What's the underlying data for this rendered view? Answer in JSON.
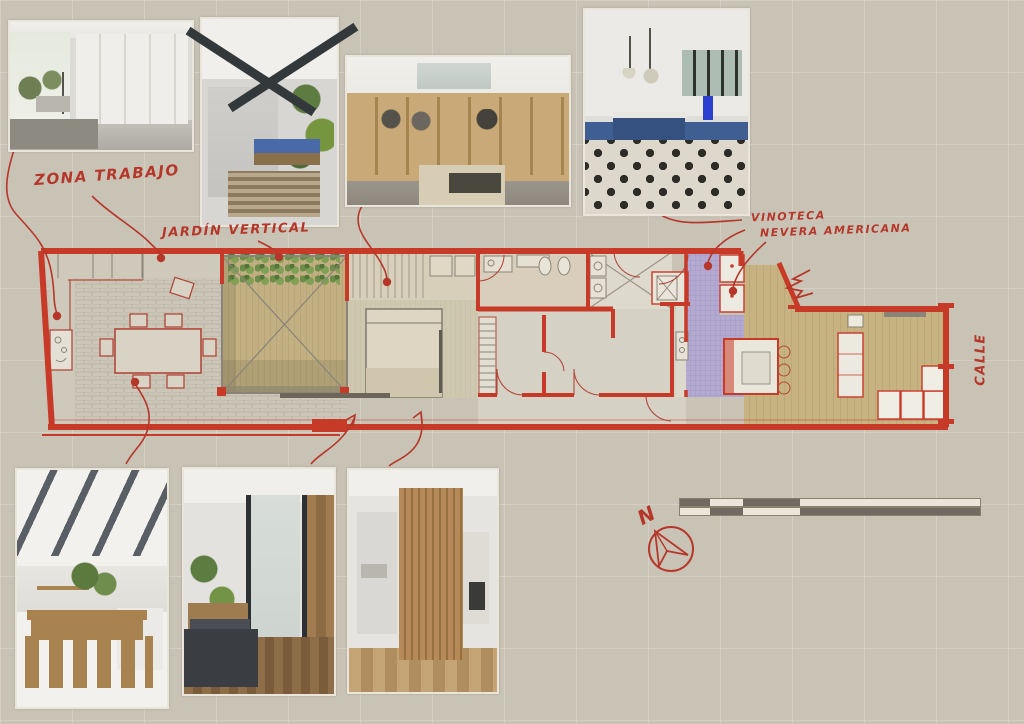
{
  "board": {
    "annotations": {
      "zona_trabajo": "ZONA TRABAJO",
      "jardin_vertical": "JARDÍN VERTICAL",
      "vinoteca": "VINOTECA",
      "nevera_americana": "NEVERA AMERICANA",
      "calle": "CALLE",
      "north_label": "N"
    },
    "photos": [
      {
        "id": "wardrobe-room",
        "label": "white wardrobe lounge room"
      },
      {
        "id": "courtyard-garden",
        "label": "courtyard with vertical garden and blue bench"
      },
      {
        "id": "walk-in-closet",
        "label": "walk-in closet with skylight"
      },
      {
        "id": "blue-kitchen",
        "label": "blue kitchen with patterned tile floor"
      },
      {
        "id": "dining-room",
        "label": "dining room with wood table and steel beams"
      },
      {
        "id": "hallway-courtyard",
        "label": "hallway beside courtyard with wood wall"
      },
      {
        "id": "wood-slat-corridor",
        "label": "corridor with wood slat partition"
      }
    ],
    "colors": {
      "paper": "#c9c3b6",
      "ink_red": "#b5372a",
      "plan_red": "#c83a28",
      "tile_purple": "#b2a8d0",
      "deck_tan": "#c3b183",
      "wood_tan": "#c8b586",
      "scale_dark": "#6f6b60",
      "scale_light": "#eae6d9"
    },
    "scale_bar": {
      "segments_px": [
        30,
        33,
        57,
        180
      ]
    }
  }
}
